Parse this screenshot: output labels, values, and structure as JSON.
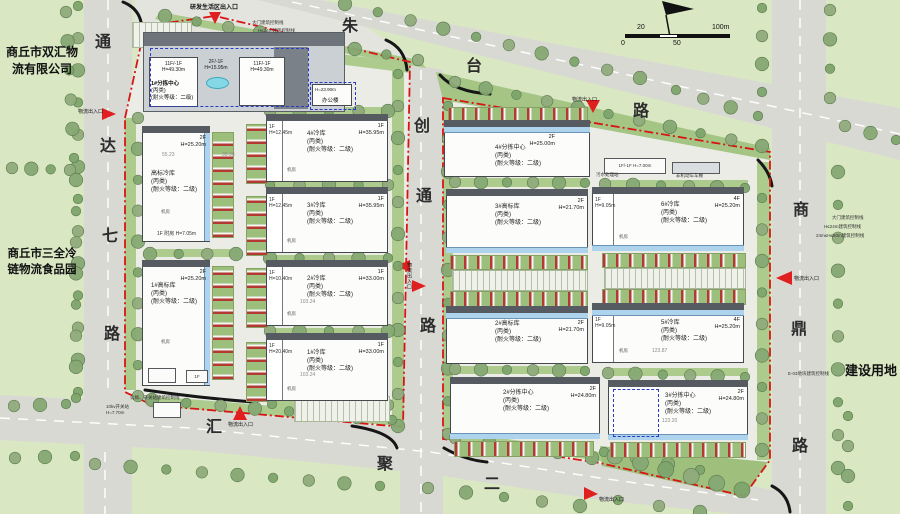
{
  "labels": {
    "company_top_left": "商丘市双汇物流有限公司",
    "company_mid_left": "商丘市三全冷链物流食品园",
    "land_use_right": "建设用地"
  },
  "roads": {
    "zhutai": [
      "朱",
      "台",
      "路"
    ],
    "tongda": [
      "通",
      "达",
      "七",
      "路"
    ],
    "chuangtong": [
      "创",
      "通",
      "路"
    ],
    "shangding": [
      "商",
      "鼎",
      "路"
    ],
    "huiju": [
      "汇",
      "聚",
      "二"
    ]
  },
  "entrances": {
    "research_living": "研发生活区出入口",
    "logistics": "物流出入口"
  },
  "scale_bar": {
    "v20": "20",
    "v100": "100m",
    "v0": "0",
    "v50": "50"
  },
  "complex": {
    "name": "1#分拣中心",
    "cls": "(丙类)",
    "fire": "(耐火等级：二级)",
    "tower_floors": "11F/-1F",
    "tower_height": "H=49.30m",
    "podium_floors": "2F/-1F",
    "podium_height": "H=15.95m"
  },
  "office": {
    "name": "办公楼",
    "height": "H=23.90m"
  },
  "buildings": [
    {
      "name": "高标冷库",
      "cls": "(丙类)",
      "fire": "(耐火等级：二级)",
      "floors": "2F",
      "height": "H=25.20m",
      "annex_floors": "1F",
      "annex": "附房 H=7.05m"
    },
    {
      "name": "1#高标库",
      "cls": "(丙类)",
      "fire": "(耐火等级：二级)",
      "floors": "2F",
      "height": "H=25.20m"
    },
    {
      "name": "4#冷库",
      "cls": "(丙类)",
      "fire": "(耐火等级：二级)",
      "floors": "1F",
      "height": "H=35.95m",
      "annex_floors": "1F",
      "annex_height": "H=12.45m"
    },
    {
      "name": "3#冷库",
      "cls": "(丙类)",
      "fire": "(耐火等级：二级)",
      "floors": "1F",
      "height": "H=35.95m",
      "annex_floors": "1F",
      "annex_height": "H=12.45m"
    },
    {
      "name": "2#冷库",
      "cls": "(丙类)",
      "fire": "(耐火等级：二级)",
      "floors": "1F",
      "height": "H=33.00m",
      "annex_floors": "1F",
      "annex_height": "H=10.40m"
    },
    {
      "name": "1#冷库",
      "cls": "(丙类)",
      "fire": "(耐火等级：二级)",
      "floors": "1F",
      "height": "H=33.00m",
      "annex_floors": "1F",
      "annex_height": "H=20.40m"
    },
    {
      "name": "4#分拣中心",
      "cls": "(丙类)",
      "fire": "(耐火等级：二级)",
      "floors": "2F",
      "height": "H=25.00m"
    },
    {
      "name": "3#高标库",
      "cls": "(丙类)",
      "fire": "(耐火等级：二级)",
      "floors": "2F",
      "height": "H=21.70m"
    },
    {
      "name": "6#冷库",
      "cls": "(丙类)",
      "fire": "(耐火等级：二级)",
      "floors": "4F",
      "height": "H=25.20m",
      "annex_floors": "1F",
      "annex_height": "H=9.05m"
    },
    {
      "name": "2#高标库",
      "cls": "(丙类)",
      "fire": "(耐火等级：二级)",
      "floors": "2F",
      "height": "H=21.70m"
    },
    {
      "name": "5#冷库",
      "cls": "(丙类)",
      "fire": "(耐火等级：二级)",
      "floors": "4F",
      "height": "H=25.20m",
      "annex_floors": "1F",
      "annex_height": "H=9.05m"
    },
    {
      "name": "2#分拣中心",
      "cls": "(丙类)",
      "fire": "(耐火等级：二级)",
      "floors": "2F",
      "height": "H=24.80m"
    },
    {
      "name": "3#分拣中心",
      "cls": "(丙类)",
      "fire": "(耐火等级：二级)",
      "floors": "2F",
      "height": "H=24.80m"
    }
  ],
  "facilities": {
    "substation": "10kv开关站",
    "substation_height": "H=7.70m",
    "sewage": "污水处理站",
    "sewage_spec": "1F/-1F H=7.00m",
    "bike_shed": "非机动车车棚",
    "gatehouse_floors": "1F",
    "machine_room": "机房"
  },
  "notes": {
    "gate_ctrl": "大门建筑控制线",
    "h24_ctrl": "H≤24m建筑控制线",
    "h2450_ctrl": "24m≤H≤50m建筑控制线",
    "wc_ctrl": "公厕、开关站建筑控制线",
    "e03_ctrl": "E-03地块建筑控制线"
  },
  "dims": [
    "55.23",
    "39.30",
    "103.24",
    "103.24",
    "123.87",
    "123.20"
  ]
}
